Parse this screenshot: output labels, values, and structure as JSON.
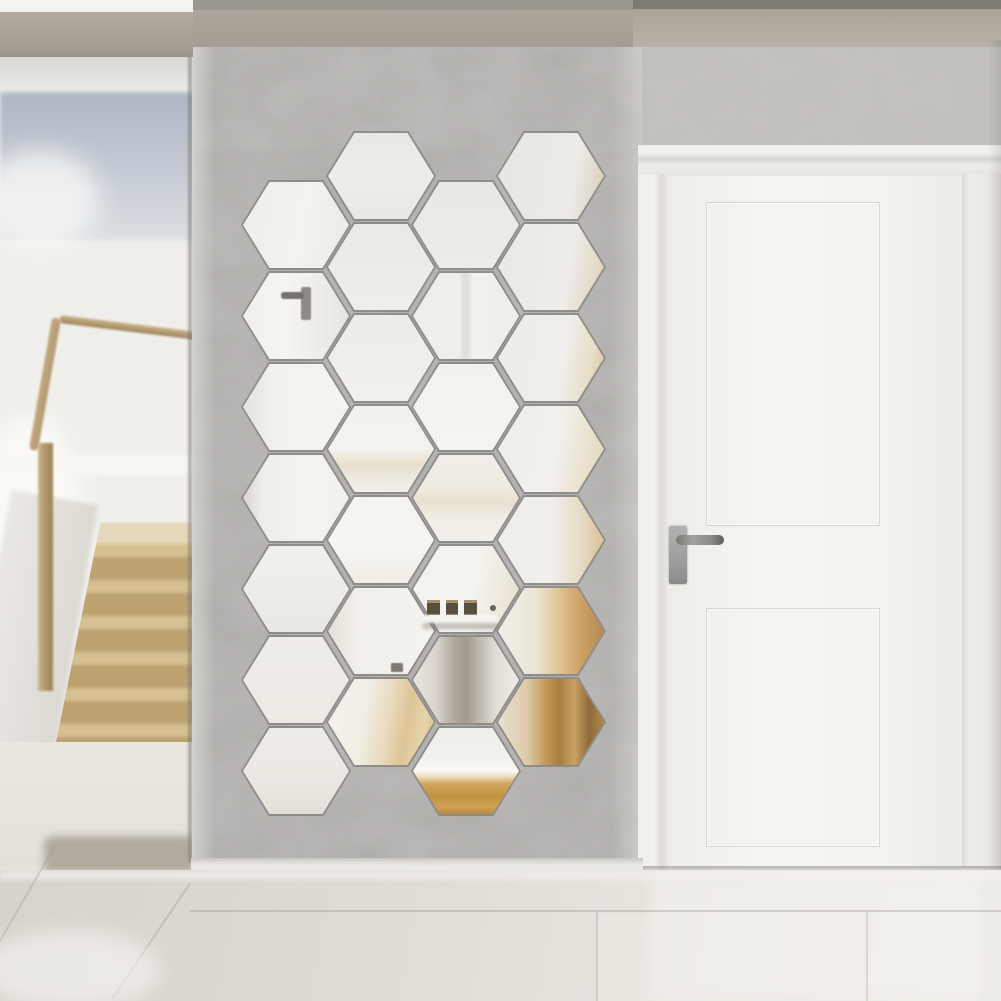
{
  "scene": {
    "type": "interior product photo",
    "subject": "honeycomb arrangement of hexagonal acrylic mirror wall stickers",
    "setting": "hallway with gray damask wallpaper accent wall, white interior door, blurred adjacent room with wooden staircase, glossy tile floor",
    "mirror_count": 28
  },
  "colors": {
    "ceiling-white": "#f5f4f0",
    "top-dark-band": "#7f7a73",
    "beam-tan": "#a49d93",
    "left-wall-white": "#efeeea",
    "window-blue-dark": "#aeb6c3",
    "window-blue-light": "#c6ccd5",
    "wood-rail": "#b49a72",
    "wood-newel": "#b39a6f",
    "stair-tread": "#d6c091",
    "stair-riser": "#bda272",
    "stair-landing": "#e6d9bb",
    "threshold-shadow": "#b1aa9e",
    "wallpaper-base": "#acaaa8",
    "wallpaper-light": "#c1bfbc",
    "frame-white": "#f0eeea",
    "door-white": "#f5f4f0",
    "handle-metal": "#9a9a98",
    "handle-lever": "#8b8985",
    "baseboard-white": "#ebe9e3",
    "floor-dark": "#d6d3cc",
    "floor-light": "#e9e7e1",
    "mirror-white": "#f2f1ed",
    "mirror-gold": "#c2933f",
    "mirror-wood": "#a87e3f"
  },
  "hex_grid": {
    "rows": 7,
    "pitch": 91,
    "hex_w": 106,
    "hex_h": 86,
    "edge_color": "rgba(104,101,97,0.5)",
    "columns": [
      {
        "x": 296,
        "y0": 225
      },
      {
        "x": 381,
        "y0": 176
      },
      {
        "x": 466,
        "y0": 225
      },
      {
        "x": 551,
        "y0": 176
      }
    ],
    "fills": {
      "c1r1": "linear-gradient(100deg,#eeede9 0%,#f3f2ee 55%,#eceae5 100%)",
      "c1r2": "linear-gradient(90deg,#f0efeb 0%,#f6f5f1 40%,#efede9 70%,#e7e5e0 100%)",
      "c1r3": "linear-gradient(90deg,#e4e2dd 0%,#f2f1ed 30%,#f5f4f0 100%)",
      "c1r4": "linear-gradient(90deg,#d8d5d0 0%,#eeede9 18%,#f4f3ef 60%,#f1f0ec 100%)",
      "c1r5": "linear-gradient(180deg,#f0efeb 0%,#eeece7 60%,#e9e7e1 100%)",
      "c1r6": "linear-gradient(180deg,#efede9 0%,#ece9e3 100%)",
      "c1r7": "linear-gradient(180deg,#eeece7 0%,#eae7e1 70%,#e2dfd8 100%)",
      "c2r1": "linear-gradient(180deg,#e9e7e3 0%,#efede9 50%,#eae8e4 100%)",
      "c2r2": "linear-gradient(180deg,#ebe9e5 0%,#efeeea 100%)",
      "c2r3": "linear-gradient(180deg,#edece8 0%,#f1f0ec 100%)",
      "c2r4": "linear-gradient(180deg,#f2f1ed 0%,#f3f2ee 50%,#e9dfce 68%,#efece5 88%,#f1efe9 100%)",
      "c2r5": "linear-gradient(180deg,#f5f4f0 0%,#f6f5f1 55%,#f0ede6 100%)",
      "c2r6": "linear-gradient(90deg,#e3e0da 0%,#f2f0ea 30%,#f4f2ec 100%)",
      "c2r7": "linear-gradient(100deg,#f3f1ea 0%,#f1eee6 35%,#e9dbbd 55%,#ddc596 72%,#e6d4ae 86%,#d2b87f 100%)",
      "c3r1": "linear-gradient(180deg,#e9e8e4 0%,#edece8 100%)",
      "c3r2": "linear-gradient(90deg,#f0eeea 0%,#f0eeea 44%,#e2e0db 47%,#e2e0db 52%,#f2f0ec 56%,#f0eeea 100%)",
      "c3r3": "linear-gradient(180deg,#f2f1ed 0%,#f5f4f0 100%)",
      "c3r4": "linear-gradient(180deg,#f0eee9 0%,#efeae0 40%,#e9e0d0 55%,#f0ede7 75%,#f2f0ea 100%)",
      "c3r5": "linear-gradient(100deg,#f3f2ee 0%,#f4f3ef 55%,#eee9df 80%,#e6dcc9 100%)",
      "c3r6": "linear-gradient(90deg,#e9e6e0 0%,#d9d4cc 22%,#b2aba0 38%,#a19a8e 50%,#bfb9ae 63%,#e0ddd5 78%,#efede7 100%)",
      "c3r7": "linear-gradient(180deg,#efede8 0%,#f4f2ec 38%,#faf8f2 50%,#e8dab8 57%,#d0a55c 65%,#c2933f 80%,#cfa055 92%,#b98c42 100%)",
      "c4r1": "linear-gradient(100deg,#e8e6e2 0%,#ecebe7 70%,#ddd3c2 92%,#d5c6ae 100%)",
      "c4r2": "linear-gradient(100deg,#eae8e4 0%,#eeede9 65%,#e2d7c3 90%,#d8c8ab 100%)",
      "c4r3": "linear-gradient(100deg,#ecebe7 0%,#f0efeb 60%,#e7dcc6 85%,#d9c29b 100%)",
      "c4r4": "linear-gradient(100deg,#efeeea 0%,#f1f0ec 55%,#ebe2d0 80%,#e3d4b8 100%)",
      "c4r5": "linear-gradient(90deg,#f0eeea 0%,#f1efeb 50%,#e9decb 75%,#ddcba8 92%,#d6c29c 100%)",
      "c4r6": "linear-gradient(90deg,#f0eee9 0%,#ece5d6 35%,#e0c99d 55%,#d4ad74 70%,#c89e62 82%,#b68a4c 100%)",
      "c4r7": "linear-gradient(90deg,#e9e1d3 0%,#ddc9a8 28%,#c59a58 45%,#a87e3f 58%,#c9a267 72%,#8f6a38 86%,#b08849 100%)"
    }
  },
  "decals": [
    {
      "name": "reflected-door-handle-plate",
      "x": 301,
      "y": 287,
      "w": 10,
      "h": 33,
      "color": "#8f8c85",
      "radius": 2,
      "blur": 0.5
    },
    {
      "name": "reflected-door-handle-lever",
      "x": 281,
      "y": 292,
      "w": 23,
      "h": 7,
      "color": "#76736d",
      "radius": 3,
      "blur": 0.5
    },
    {
      "name": "reflected-frame-1",
      "x": 427,
      "y": 600,
      "w": 13,
      "h": 15,
      "color": "#564f3e",
      "top": "#a29274"
    },
    {
      "name": "reflected-frame-2",
      "x": 446,
      "y": 600,
      "w": 12,
      "h": 15,
      "color": "#564f3e",
      "top": "#a29274"
    },
    {
      "name": "reflected-frame-3",
      "x": 464,
      "y": 600,
      "w": 13,
      "h": 15,
      "color": "#564f3e",
      "top": "#a29274"
    },
    {
      "name": "reflected-frame-dot",
      "x": 490,
      "y": 605,
      "w": 6,
      "h": 6,
      "color": "#6b6456",
      "radius": 3
    },
    {
      "name": "reflected-ledge",
      "x": 423,
      "y": 615,
      "w": 74,
      "h": 8,
      "color": "#f6f5f0",
      "blur": 1
    },
    {
      "name": "reflected-ledge-shadow",
      "x": 423,
      "y": 623,
      "w": 74,
      "h": 6,
      "color": "rgba(110,104,94,0.35)",
      "blur": 1.5
    },
    {
      "name": "reflected-knob",
      "x": 391,
      "y": 663,
      "w": 12,
      "h": 9,
      "color": "#7d7973",
      "radius": 1,
      "blur": 0.5
    }
  ],
  "staircase": {
    "visible_steps": 6,
    "step_height": 36,
    "tread_height": 13,
    "landing_height": 22
  }
}
